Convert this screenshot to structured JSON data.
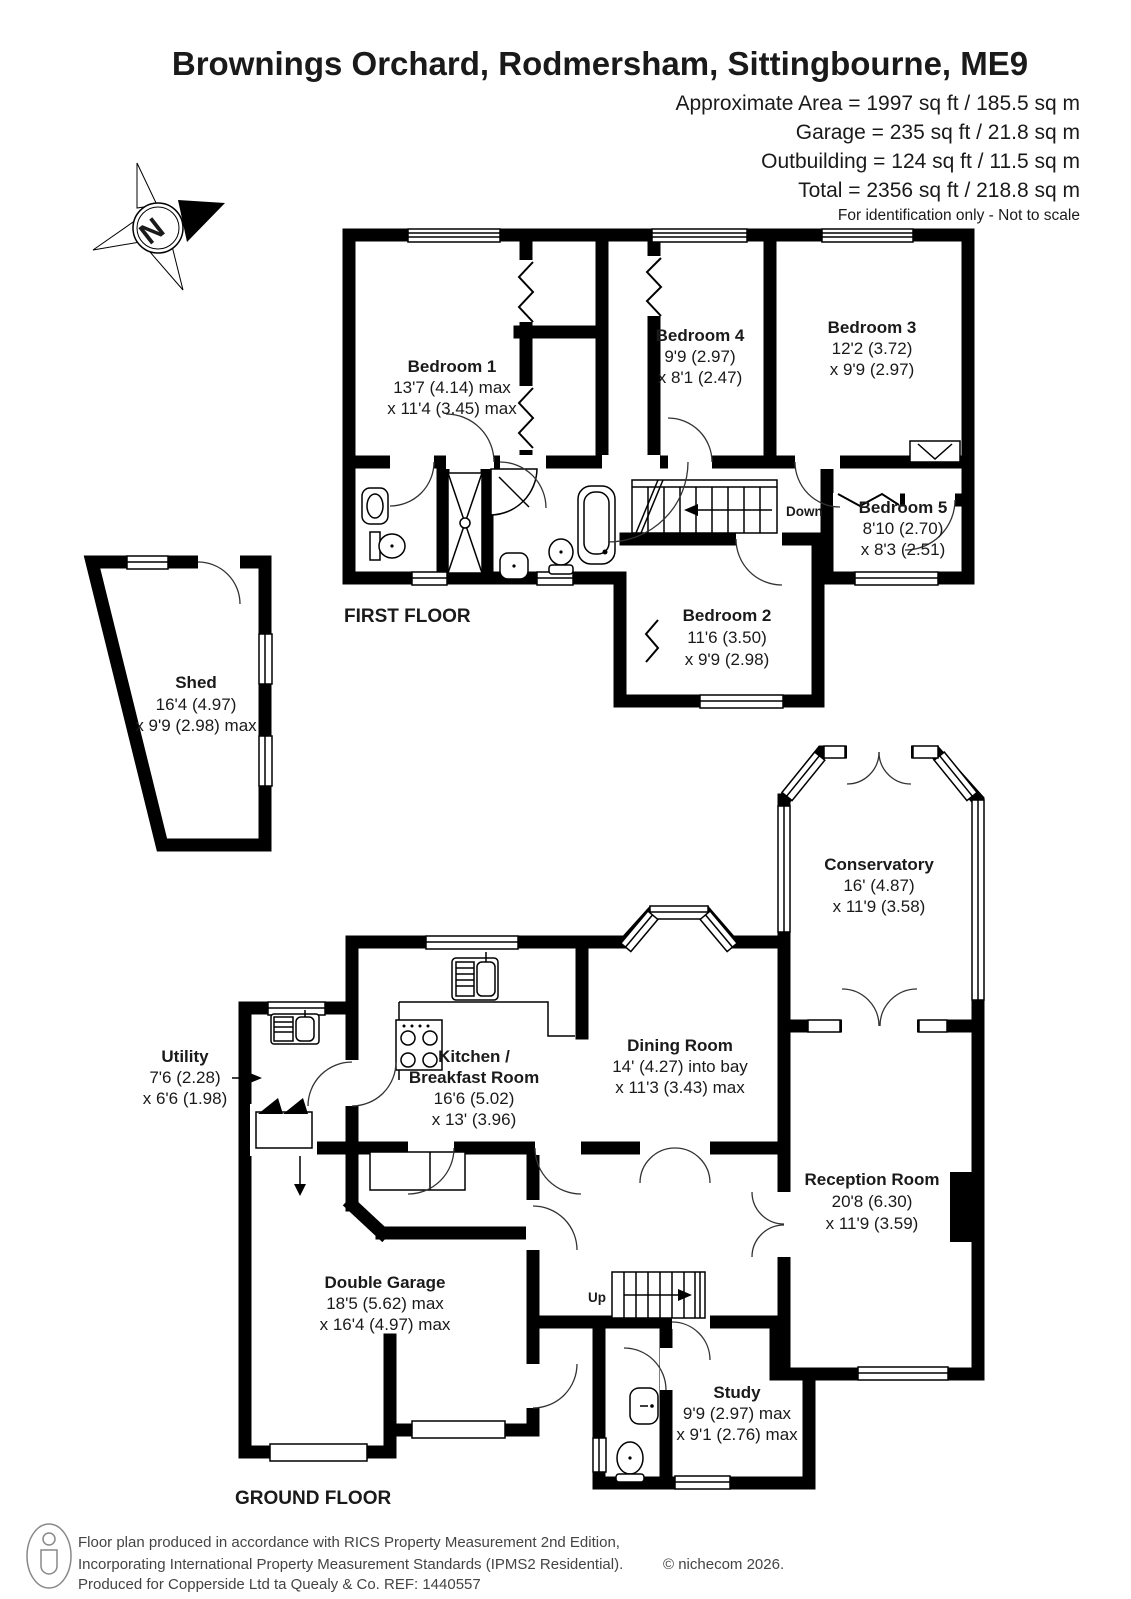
{
  "header": {
    "title": "Brownings Orchard, Rodmersham, Sittingbourne, ME9",
    "area_lines": [
      "Approximate Area = 1997 sq ft / 185.5 sq m",
      "Garage = 235 sq ft / 21.8 sq m",
      "Outbuilding = 124 sq ft / 11.5 sq m",
      "Total = 2356 sq ft / 218.8 sq m"
    ],
    "disclaimer": "For identification only - Not to scale"
  },
  "compass": {
    "north_label": "N"
  },
  "first_floor": {
    "label": "FIRST FLOOR",
    "stairs_label": "Down",
    "rooms": [
      {
        "name": "Bedroom 1",
        "dim1": "13'7 (4.14) max",
        "dim2": "x 11'4 (3.45) max"
      },
      {
        "name": "Bedroom 4",
        "dim1": "9'9 (2.97)",
        "dim2": "x 8'1 (2.47)"
      },
      {
        "name": "Bedroom 3",
        "dim1": "12'2 (3.72)",
        "dim2": "x 9'9 (2.97)"
      },
      {
        "name": "Bedroom 5",
        "dim1": "8'10 (2.70)",
        "dim2": "x 8'3 (2.51)"
      },
      {
        "name": "Bedroom 2",
        "dim1": "11'6 (3.50)",
        "dim2": "x 9'9 (2.98)"
      }
    ]
  },
  "outbuilding": {
    "shed": {
      "name": "Shed",
      "dim1": "16'4 (4.97)",
      "dim2": "x 9'9 (2.98) max"
    }
  },
  "ground_floor": {
    "label": "GROUND FLOOR",
    "stairs_label": "Up",
    "rooms": [
      {
        "name": "Conservatory",
        "dim1": "16' (4.87)",
        "dim2": "x 11'9 (3.58)"
      },
      {
        "name": "Dining Room",
        "dim1": "14' (4.27) into bay",
        "dim2": "x 11'3 (3.43) max"
      },
      {
        "name": "Kitchen /",
        "name2": "Breakfast Room",
        "dim1": "16'6 (5.02)",
        "dim2": "x 13' (3.96)"
      },
      {
        "name": "Utility",
        "dim1": "7'6 (2.28)",
        "dim2": "x 6'6 (1.98)"
      },
      {
        "name": "Reception Room",
        "dim1": "20'8 (6.30)",
        "dim2": "x 11'9 (3.59)"
      },
      {
        "name": "Double Garage",
        "dim1": "18'5 (5.62) max",
        "dim2": "x 16'4 (4.97) max"
      },
      {
        "name": "Study",
        "dim1": "9'9 (2.97) max",
        "dim2": "x 9'1 (2.76) max"
      }
    ]
  },
  "footer": {
    "line1": "Floor plan produced in accordance with RICS Property Measurement 2nd Edition,",
    "line2": "Incorporating International Property Measurement Standards (IPMS2 Residential).",
    "line3": "Produced for Copperside Ltd ta Quealy & Co.   REF: 1440557",
    "copyright": "© nichecom 2026."
  },
  "colors": {
    "walls": "#000000",
    "background": "#ffffff",
    "text": "#1a1a1a"
  }
}
